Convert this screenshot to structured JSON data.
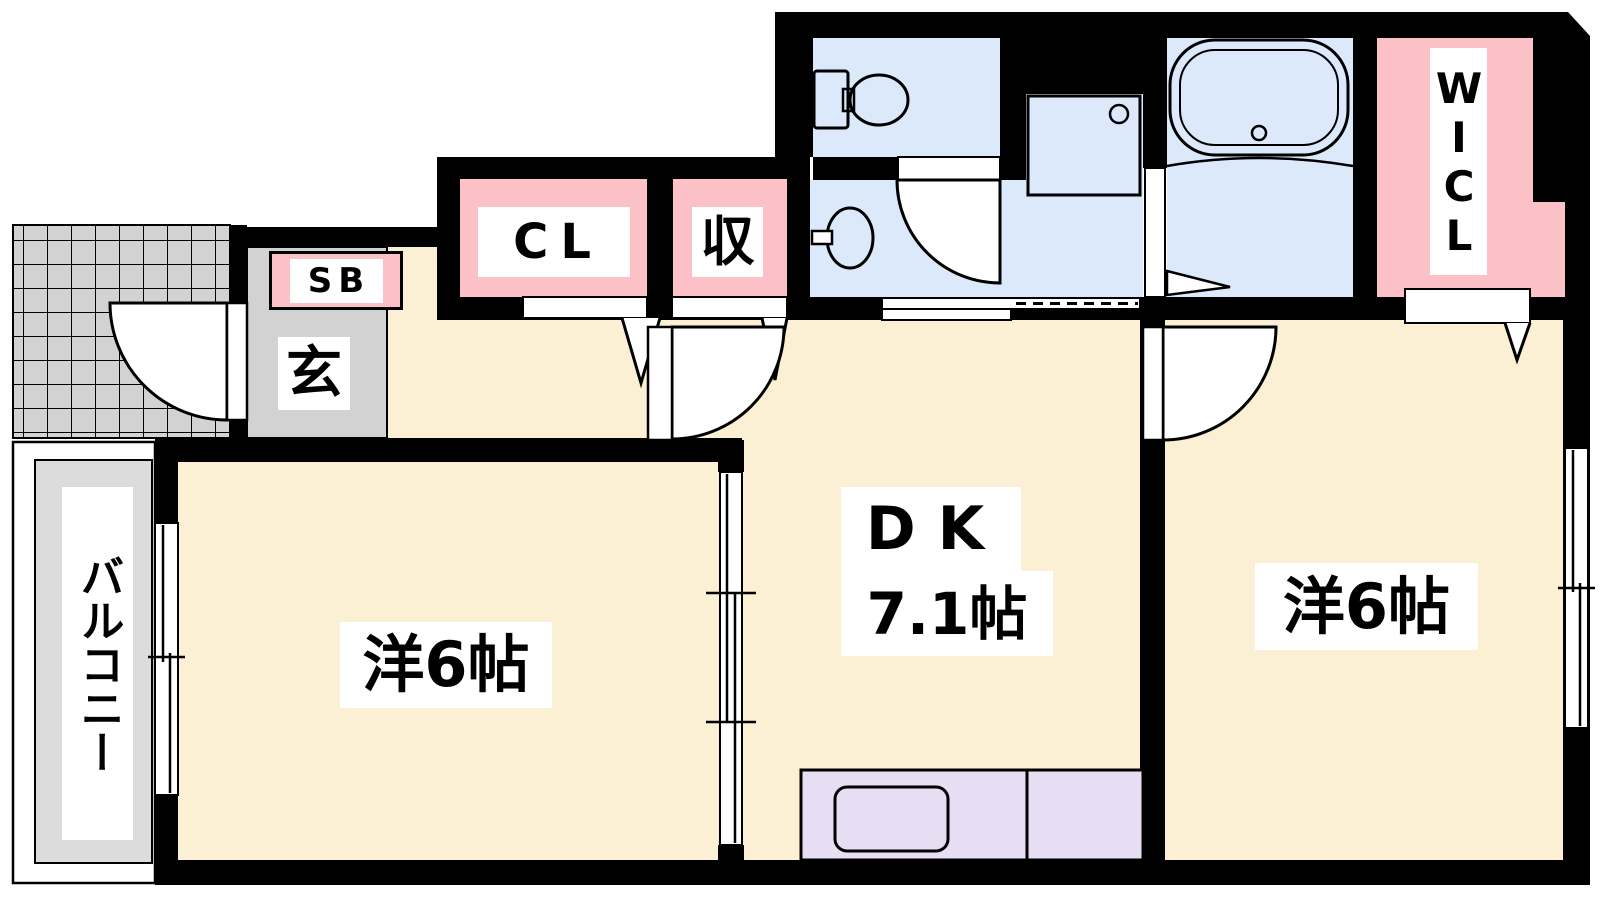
{
  "floorplan": {
    "title": "Japanese apartment floor plan (2DK)",
    "labels": {
      "shoe_box": "SB",
      "entrance": "玄",
      "closet": "CL",
      "storage": "収",
      "walk_in_closet": "WICL",
      "balcony": "バルコニー",
      "western_room_left": "洋6帖",
      "dk": "DK",
      "dk_size": "7.1帖",
      "western_room_right": "洋6帖"
    },
    "colors": {
      "floor_cream": "#FBF0D4",
      "closet_pink": "#FCC1C6",
      "wet_area_blue": "#DCE9FA",
      "kitchen_counter_lavender": "#E7DEF4",
      "entrance_gray": "#D2D2D2",
      "wall": "#000000"
    }
  }
}
